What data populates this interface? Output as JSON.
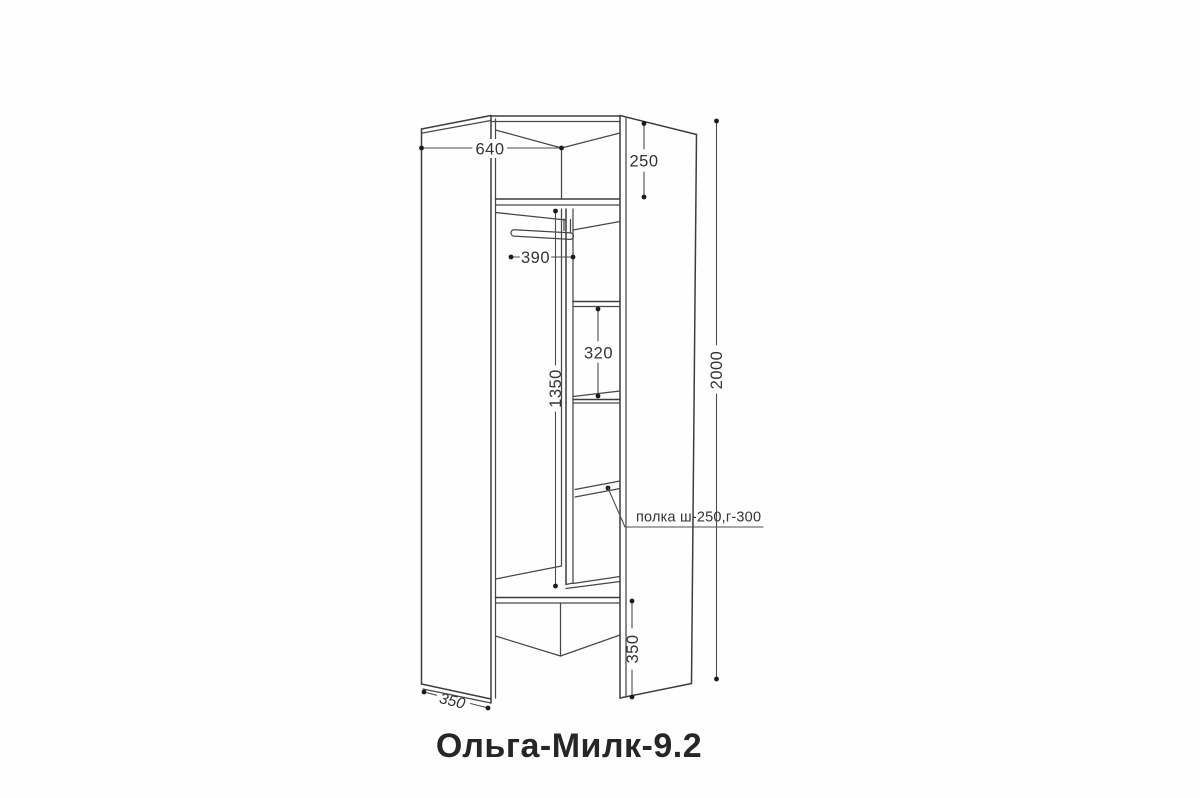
{
  "drawing": {
    "title": "Ольга-Милк-9.2",
    "dimensions": {
      "top_width": "640",
      "top_shelf_height": "250",
      "rod_length": "390",
      "hanging_section_height": "1350",
      "shelf_spacing": "320",
      "total_height": "2000",
      "plinth_height": "350",
      "side_depth": "350"
    },
    "annotations": {
      "shelf_note": "полка ш-250,г-300"
    },
    "colors": {
      "line": "#3d3d3d",
      "dimension_line": "#4d4d4d",
      "text": "#333333",
      "title_text": "#262626",
      "background": "#fefefe"
    }
  }
}
